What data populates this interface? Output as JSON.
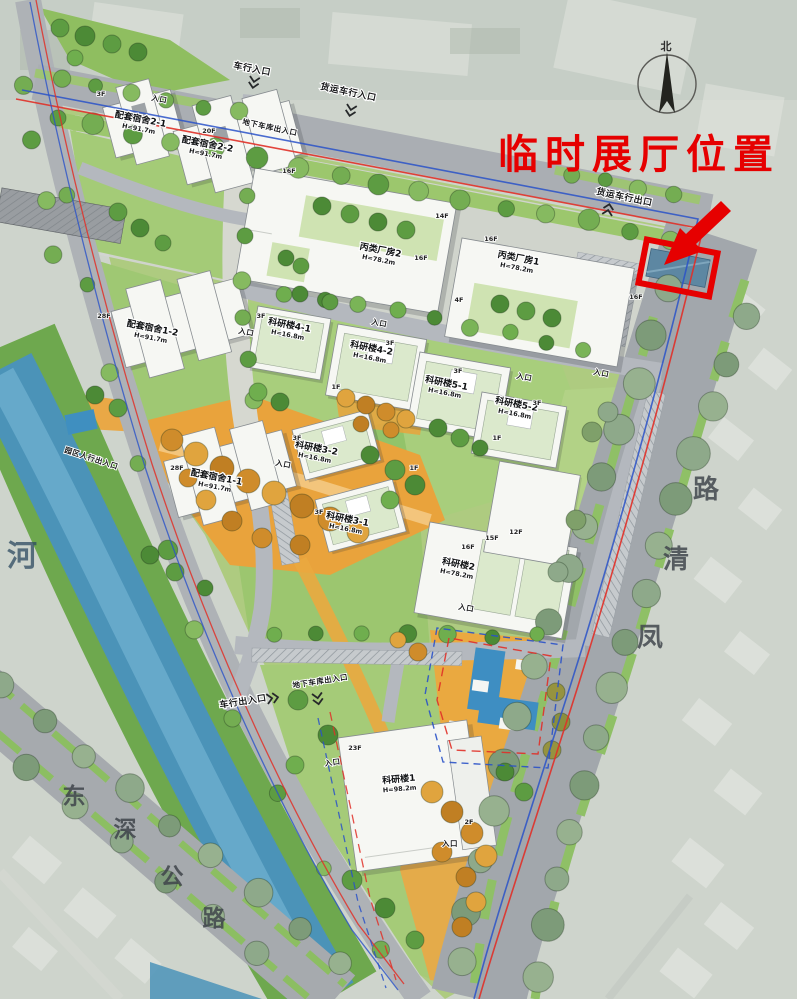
{
  "annotation": {
    "label": "临时展厅位置"
  },
  "compass": {
    "north": "北"
  },
  "roads": {
    "fengqing_chars": [
      "凤",
      "清",
      "路"
    ],
    "dongshen_chars": [
      "东",
      "深",
      "公",
      "路"
    ],
    "river": "河"
  },
  "entrances": {
    "vehicle_in": "车行入口",
    "freight_in": "货运车行入口",
    "freight_out": "货运车行出口",
    "underground_garage": "地下车库出入口",
    "park_pedestrian": "园区人行出入口",
    "vehicle_inout": "车行出入口",
    "entrance": "入口"
  },
  "buildings": [
    {
      "name": "配套宿舍2-1",
      "height": "H=91.7m"
    },
    {
      "name": "配套宿舍2-2",
      "height": "H=91.7m"
    },
    {
      "name": "丙类厂房2",
      "height": "H=78.2m"
    },
    {
      "name": "丙类厂房1",
      "height": "H=78.2m"
    },
    {
      "name": "配套宿舍1-2",
      "height": "H=91.7m"
    },
    {
      "name": "科研楼4-1",
      "height": "H=16.8m"
    },
    {
      "name": "科研楼4-2",
      "height": "H=16.8m"
    },
    {
      "name": "科研楼5-1",
      "height": "H=16.8m"
    },
    {
      "name": "科研楼5-2",
      "height": "H=16.8m"
    },
    {
      "name": "科研楼3-2",
      "height": "H=16.8m"
    },
    {
      "name": "科研楼3-1",
      "height": "H=16.8m"
    },
    {
      "name": "配套宿舍1-1",
      "height": "H=91.7m"
    },
    {
      "name": "科研楼2",
      "height": "H=78.2m"
    },
    {
      "name": "科研楼1",
      "height": "H=98.2m"
    }
  ],
  "floors": {
    "f1": "1F",
    "f2": "2F",
    "f3": "3F",
    "f4": "4F",
    "f12": "12F",
    "f14": "14F",
    "f15": "15F",
    "f16": "16F",
    "f20": "20F",
    "f23": "23F",
    "f28": "28F"
  },
  "colors": {
    "annotation_red": "#e60000",
    "boundary_red": "#e03028",
    "boundary_blue": "#2a52c8",
    "river_blue": "#4b93b8"
  }
}
